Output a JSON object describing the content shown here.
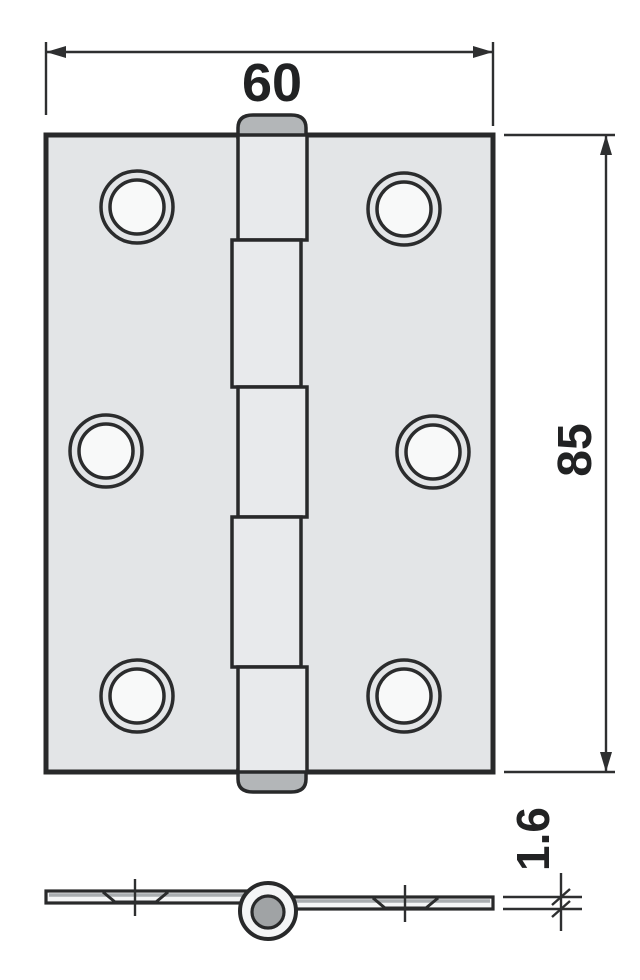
{
  "drawing": {
    "subject": "butt-hinge",
    "views": {
      "front": "front view with six countersunk screw holes and five-segment knuckle",
      "edge": "bottom edge view with pin barrel and two countersunk leaves"
    },
    "hole_count": 6,
    "knuckle_segments": 5
  },
  "dimensions": {
    "width": "60",
    "height": "85",
    "thickness": "1.6"
  },
  "colors": {
    "outline": "#28292a",
    "dimension_line": "#2e2f30",
    "text": "#212223",
    "leaf_fill": "#e3e5e7",
    "knuckle_fill": "#e8eaec",
    "cap_fill": "#b3b6b8",
    "pin_fill": "#a0a3a5",
    "hole_fill": "#f8f9f9",
    "plate_fill": "#f4f5f6",
    "background": "#ffffff"
  }
}
